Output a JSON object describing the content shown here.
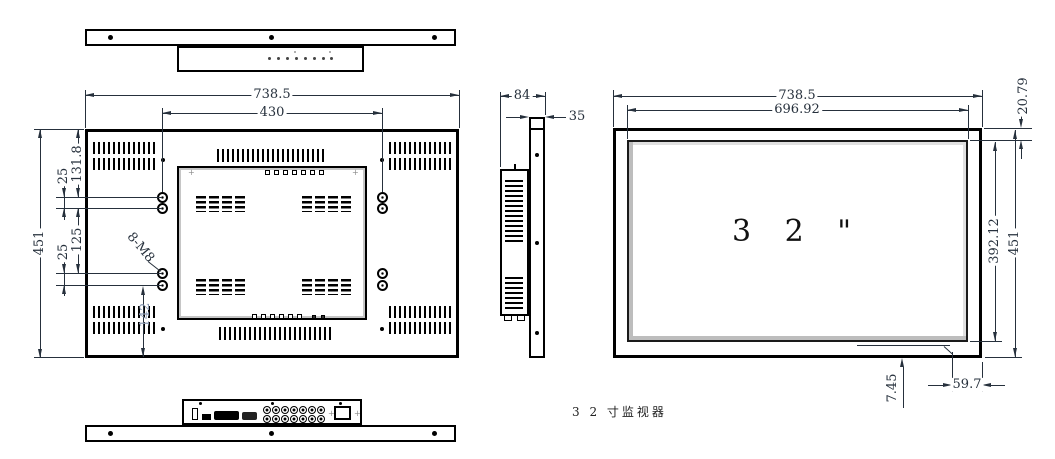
{
  "caption": "3 2 寸监视器",
  "views": {
    "back": {
      "width": "738.5",
      "mount_span": "430",
      "height": "451",
      "pitch_top": "25",
      "edge_to_hole_top": "131.8",
      "pitch_bottom": "25",
      "span_mid": "125",
      "edge_to_hole_bottom": "142",
      "holes_callout": "8-M8"
    },
    "side": {
      "depth": "84",
      "bezel_depth": "35"
    },
    "front": {
      "width": "738.5",
      "screen_width": "696.92",
      "top_margin": "20.79",
      "screen_height": "392.12",
      "height": "451",
      "bottom_margin": "7.45",
      "side_offset": "59.7",
      "size_label": "3 2 \""
    }
  }
}
